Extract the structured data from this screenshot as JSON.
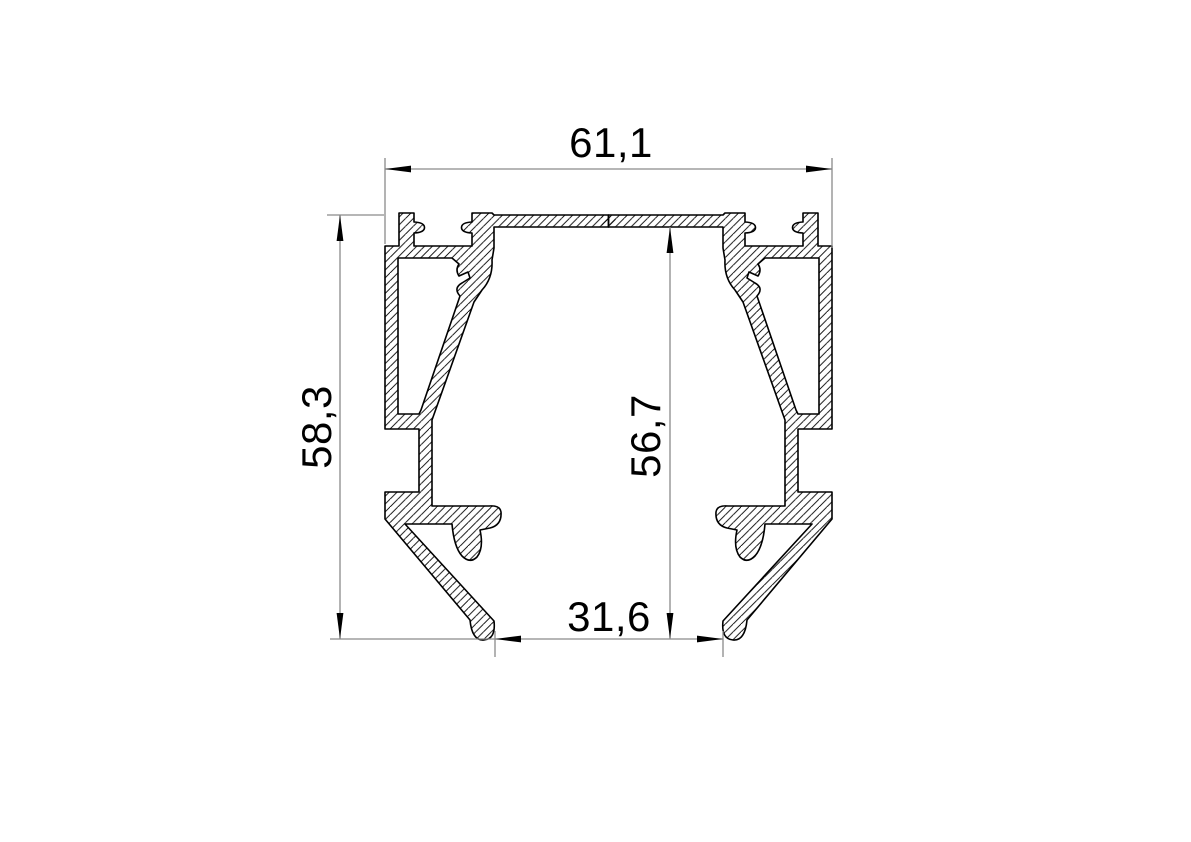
{
  "drawing": {
    "type": "technical-profile-cross-section",
    "dimensions": [
      {
        "id": "width-top",
        "label": "61,1",
        "value_mm": 61.1,
        "role": "overall-width",
        "orientation": "horizontal"
      },
      {
        "id": "height-left",
        "label": "58,3",
        "value_mm": 58.3,
        "role": "overall-height",
        "orientation": "vertical"
      },
      {
        "id": "height-inner",
        "label": "56,7",
        "value_mm": 56.7,
        "role": "inner-cavity-height",
        "orientation": "vertical"
      },
      {
        "id": "width-bottom",
        "label": "31,6",
        "value_mm": 31.6,
        "role": "bottom-opening-width",
        "orientation": "horizontal"
      }
    ],
    "colors": {
      "outline": "#000000",
      "dimension_line": "#8a8a8a",
      "text": "#000000",
      "background": "#ffffff"
    }
  }
}
